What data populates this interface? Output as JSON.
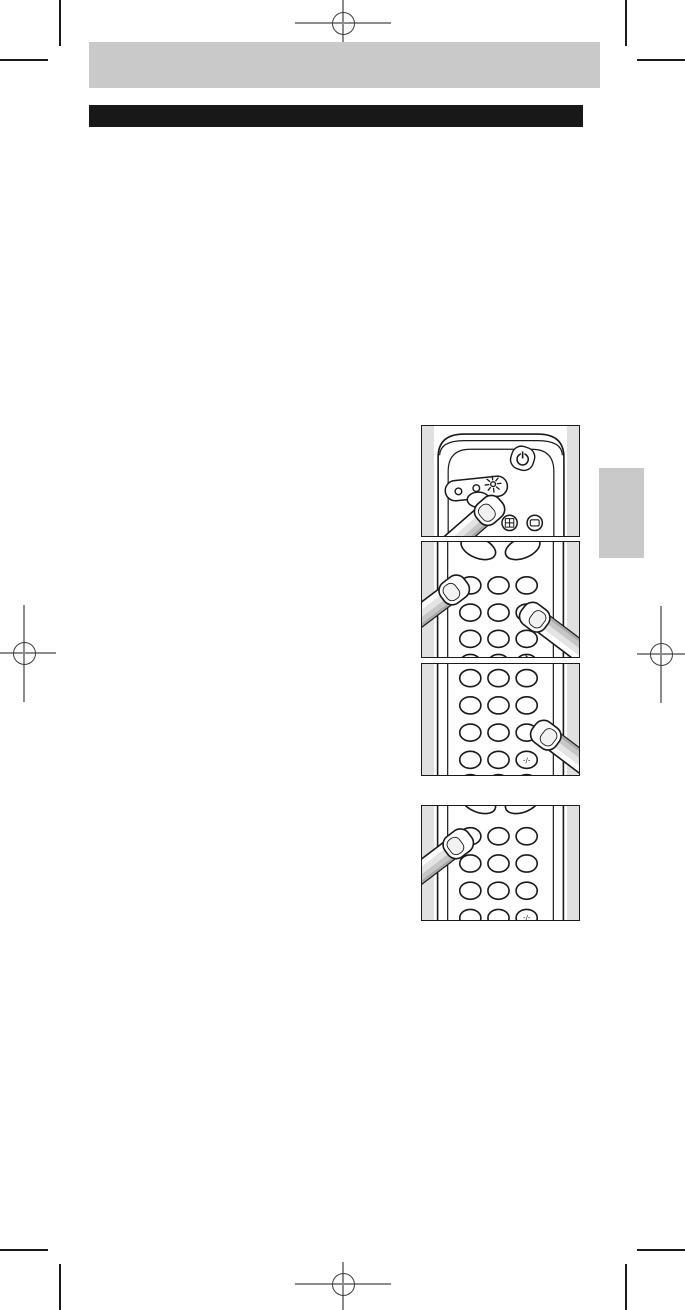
{
  "document": {
    "kind": "manual-page-proof",
    "colors": {
      "page_background": "#ffffff",
      "header_band": "#c9c9c9",
      "title_band": "#181818",
      "chapter_tab": "#c9c9c9",
      "illustration_margin": "#e0e0e0",
      "line_art": "#1a1a1a",
      "print_mark_line": "#8c8c8c",
      "print_mark_circle": "#3c3c3c"
    },
    "header_band_text": "",
    "title_band_text": ""
  },
  "illustrations": [
    {
      "alt": "Fingertip pressing the recessed button below the LED indicator panel on the head of the remote control",
      "icons": [
        "power-icon",
        "led-dot",
        "led-dot",
        "blinking-led-icon",
        "plus-grid-icon",
        "display-icon"
      ]
    },
    {
      "alt": "Two fingertips pressing buttons on the remote control keypad"
    },
    {
      "alt": "Fingertip pressing the keypad button beside the -/- key",
      "key_label": "-/-"
    },
    {
      "alt": "Fingertip pressing the upper-left keypad button",
      "key_label": "-/-"
    }
  ]
}
